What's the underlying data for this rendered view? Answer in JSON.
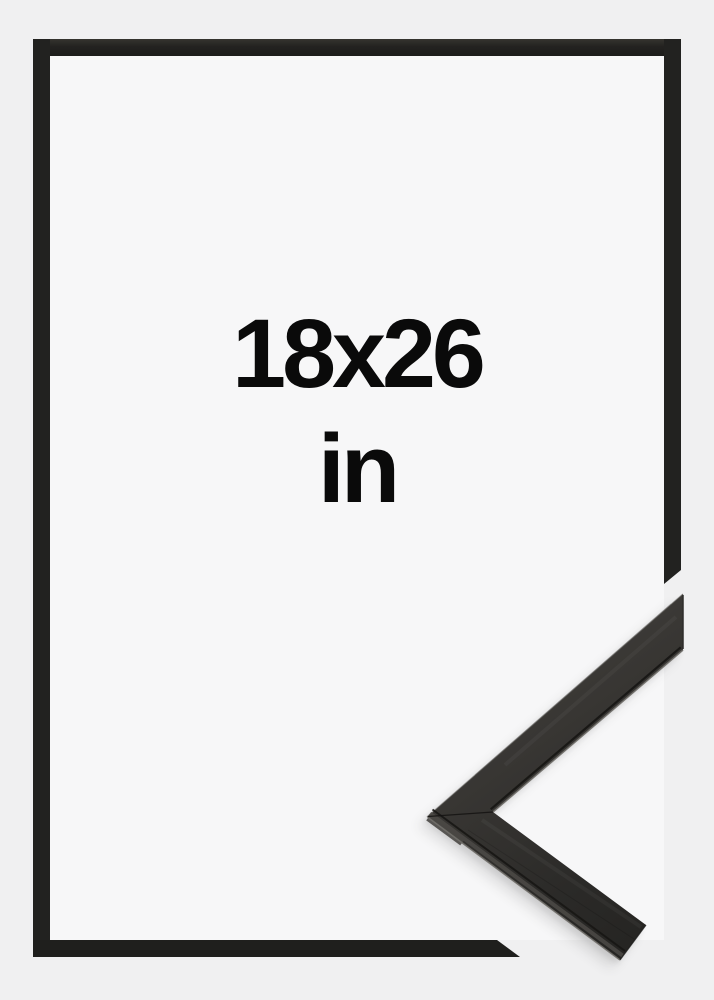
{
  "product_photo": {
    "size_label": {
      "dimensions": "18x26",
      "unit": "in"
    },
    "colors": {
      "background": "#f0f0f1",
      "inner_background": "#f7f7f8",
      "frame_outline": "#222220",
      "label_text": "#0a0a0a",
      "moulding_dark": "#242321",
      "moulding_light": "#4a4845",
      "moulding_lip_highlight": "#6e6c67"
    }
  }
}
